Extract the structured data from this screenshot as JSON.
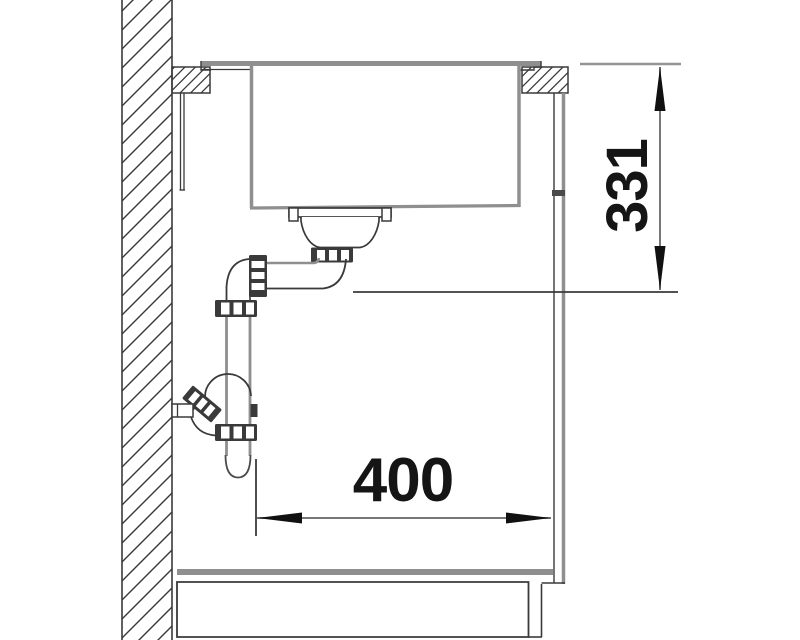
{
  "drawing": {
    "dimensions": {
      "height_mm": "331",
      "width_mm": "400"
    },
    "colors": {
      "background": "#ffffff",
      "line_dark": "#3a3a3a",
      "line_gray": "#8f8f8f",
      "fitting_dark": "#3a3a3a",
      "dim_line": "#777777",
      "arrow": "#111111",
      "text": "#151515"
    }
  }
}
